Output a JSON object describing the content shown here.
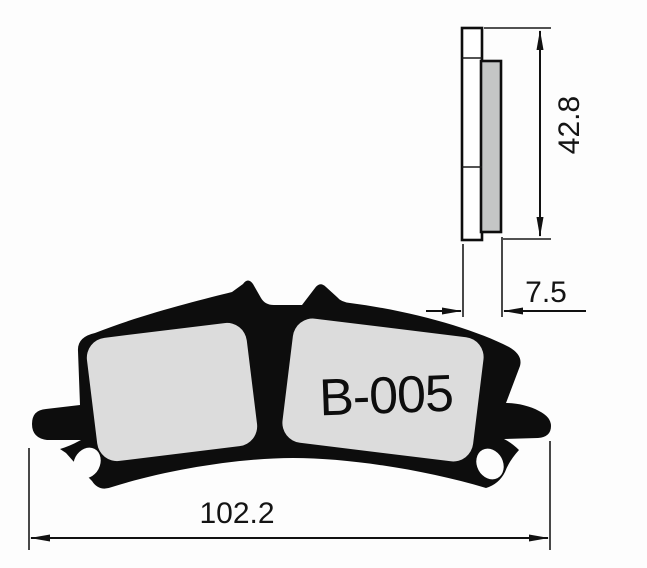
{
  "drawing": {
    "part_label": "B-005",
    "dimensions": {
      "width": "102.2",
      "height": "42.8",
      "thickness": "7.5"
    },
    "colors": {
      "outline_black": "#0d0d0d",
      "front_pad_fill": "#dcdcdc",
      "side_pad_fill": "#c4c6c5",
      "background": "#fdfdfd"
    }
  }
}
